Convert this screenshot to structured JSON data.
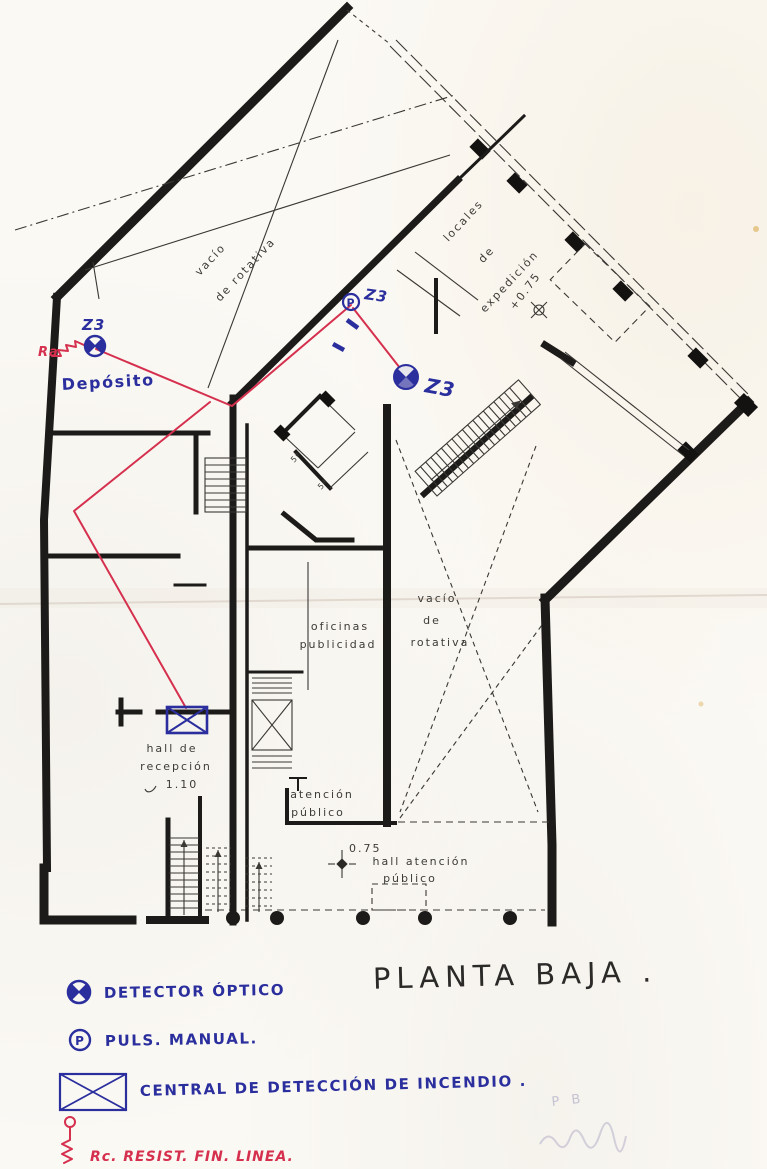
{
  "title": {
    "text": "PLANTA BAJA ."
  },
  "plan_labels": {
    "vacio_upper_1": "vacío",
    "vacio_upper_2": "de rotativa",
    "locales_1": "locales",
    "locales_2": "de",
    "locales_3": "expedición",
    "level_top": "+0.75",
    "oficinas_1": "oficinas",
    "oficinas_2": "publicidad",
    "vacio_lower_1": "vacío",
    "vacio_lower_2": "de",
    "vacio_lower_3": "rotativa",
    "hall_recepcion_1": "hall de",
    "hall_recepcion_2": "recepción",
    "hall_recepcion_level": "1.10",
    "atencion_1": "atención",
    "atencion_2": "público",
    "hall_atencion_level": "0.75",
    "hall_atencion_1": "hall atención",
    "hall_atencion_2": "público",
    "small_room_a": "5ª",
    "small_room_b": "5ª"
  },
  "annotations": {
    "zone_1": "Z3",
    "zone_2": "Z3",
    "zone_3": "Z3",
    "deposito": "Depósito",
    "resistor_tag": "Ra",
    "pulsador_letter": "P"
  },
  "legend": {
    "detector_label": "DETECTOR ÓPTICO",
    "pulsador_symbol_letter": "P",
    "pulsador_label": "PULS. MANUAL.",
    "central_label": "CENTRAL DE DETECCIÓN DE INCENDIO .",
    "resistor_label": "Rc.   RESIST. FIN. LINEA."
  },
  "pencil": {
    "note": "P B"
  },
  "colors": {
    "blue_ink": "#2b2f9e",
    "red_ink": "#d5304e",
    "wall_black": "#1d1b19",
    "paper": "#fbf9f4",
    "pencil_gray": "#b9b5cc"
  }
}
